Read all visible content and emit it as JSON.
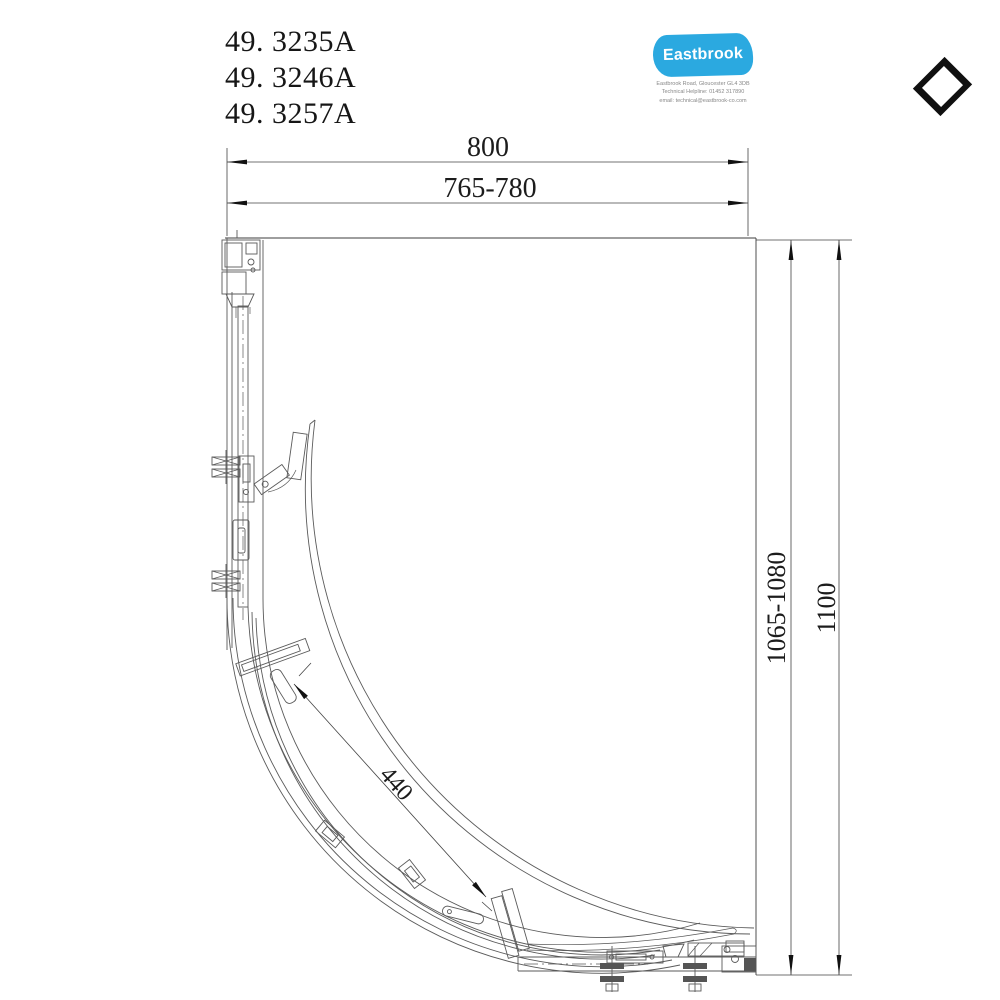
{
  "meta": {
    "title": "Quadrant shower enclosure plan drawing"
  },
  "product_codes": [
    "49. 3235A",
    "49. 3246A",
    "49. 3257A"
  ],
  "logo": {
    "brand": "Eastbrook",
    "brand_color": "#2BA9E0",
    "address": "Eastbrook Road, Gloucester GL4 3DB",
    "helpline": "Technical Helpline: 01452 317890",
    "email": "email: technical@eastbrook-co.com"
  },
  "icons": {
    "corner_marker": "diamond-icon"
  },
  "dimensions": {
    "width_overall": "800",
    "width_adjust": "765-780",
    "height_overall": "1100",
    "height_adjust": "1065-1080",
    "door_radius": "440"
  },
  "colors": {
    "line": "#5a5a5a",
    "dimension_text": "#1c1c1c",
    "background": "#ffffff"
  }
}
